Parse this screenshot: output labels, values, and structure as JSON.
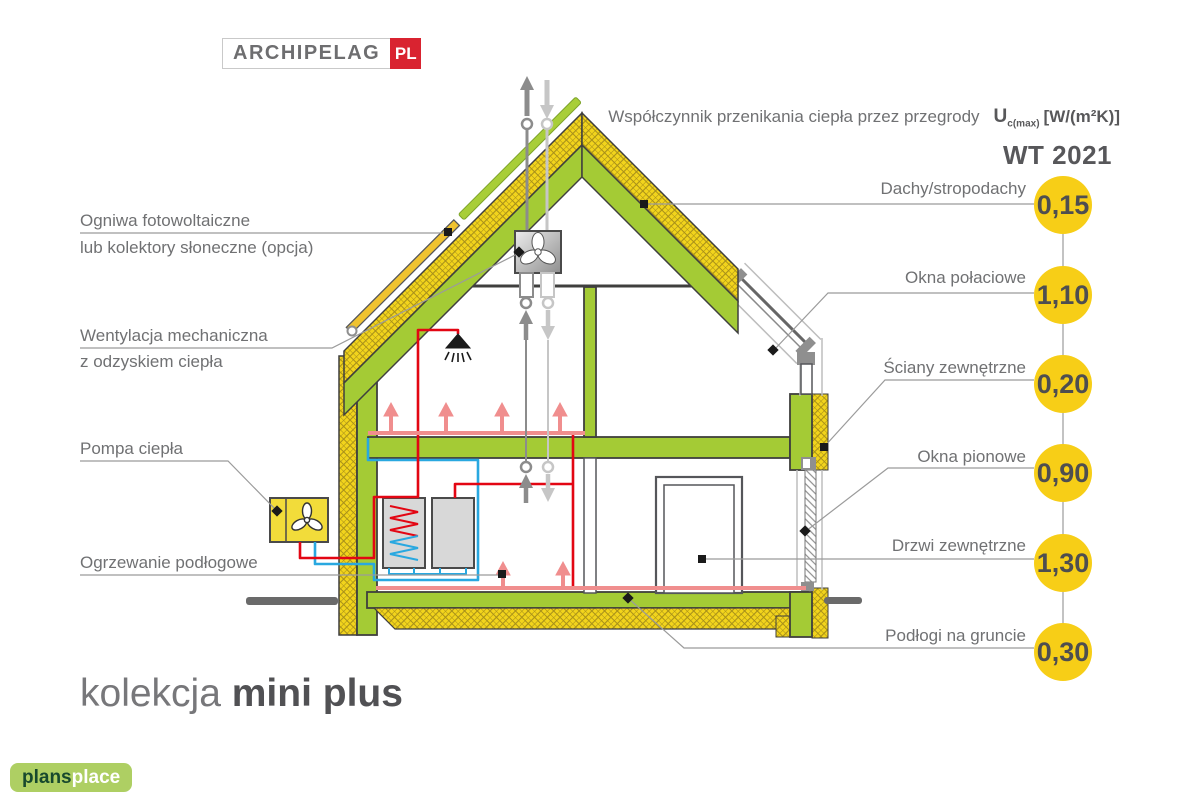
{
  "brand": {
    "archipelag": "ARCHIPELAG",
    "pl": "PL"
  },
  "footer_logo": {
    "bold": "plans",
    "light": "place"
  },
  "header": {
    "title": "Współczynnik przenikania ciepła przez przegrody",
    "u_symbol": "U",
    "u_sub": "c(max)",
    "units": "[W/(m²K)]",
    "standard": "WT 2021"
  },
  "collection": {
    "prefix": "kolekcja ",
    "name": "mini plus"
  },
  "left_labels": [
    {
      "line1": "Ogniwa fotowoltaiczne",
      "line2": "lub kolektory słoneczne (opcja)"
    },
    {
      "line1": "Wentylacja mechaniczna",
      "line2": "z odzyskiem ciepła"
    },
    {
      "line1": "Pompa ciepła",
      "line2": ""
    },
    {
      "line1": "Ogrzewanie podłogowe",
      "line2": ""
    }
  ],
  "coefficients": [
    {
      "label": "Dachy/stropodachy",
      "value": "0,15"
    },
    {
      "label": "Okna połaciowe",
      "value": "1,10"
    },
    {
      "label": "Ściany zewnętrzne",
      "value": "0,20"
    },
    {
      "label": "Okna pionowe",
      "value": "0,90"
    },
    {
      "label": "Drzwi zewnętrzne",
      "value": "1,30"
    },
    {
      "label": "Podłogi na gruncie",
      "value": "0,30"
    }
  ],
  "colors": {
    "wall_green": "#a4cb35",
    "insulation_yellow": "#f2d41c",
    "value_circle": "#f7ce17",
    "pipe_red": "#e30613",
    "pipe_blue": "#29a8e0",
    "floor_heating_pink": "#f08e8e",
    "duct_dark": "#8c8c8c",
    "duct_light": "#c6c6c6",
    "leader_gray": "#9b9b9b",
    "logo_red": "#d92330",
    "footer_green": "#aecf63"
  }
}
